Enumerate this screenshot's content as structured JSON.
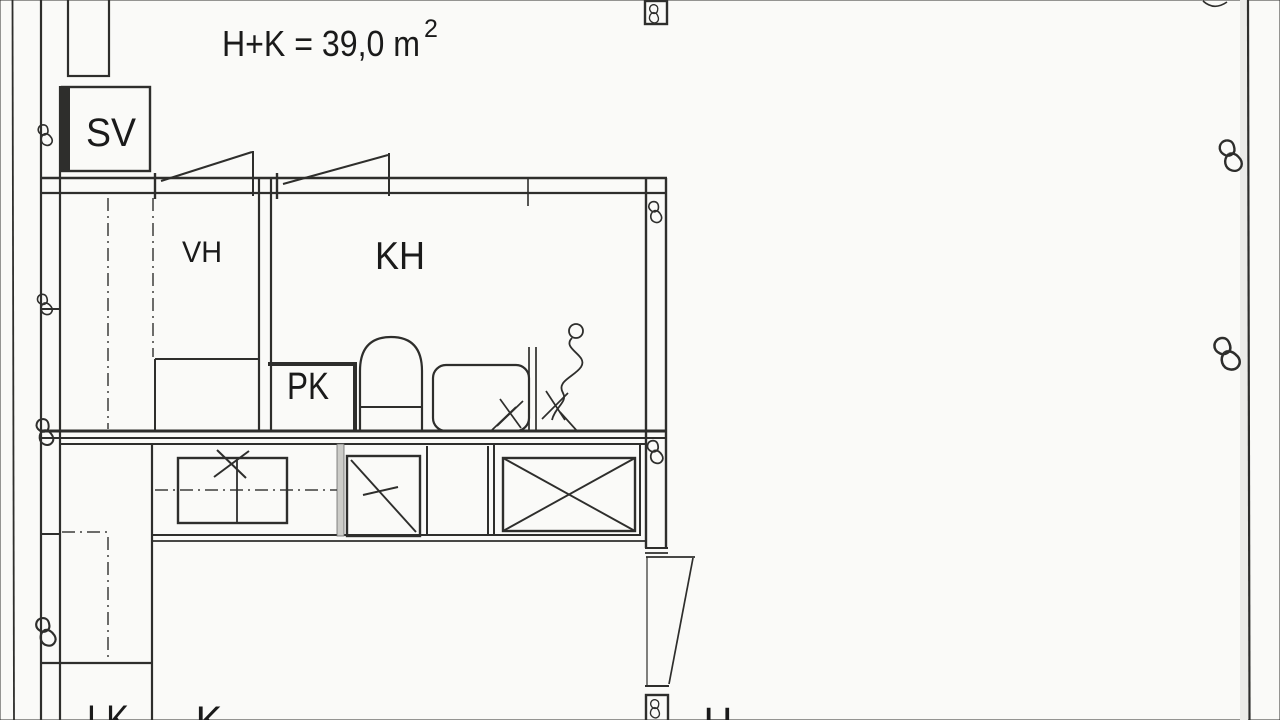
{
  "document": {
    "area_label": {
      "text": "H+K = 39,0 m",
      "superscript": "2"
    },
    "rooms": {
      "sv": "SV",
      "vh": "VH",
      "kh": "KH",
      "pk": "PK",
      "lk": "LK",
      "k": "K",
      "h": "H"
    },
    "colors": {
      "ink": "#2e2e2c",
      "text": "#1a1a1a",
      "paper": "#fafaf8",
      "shade": "#ebebe8"
    }
  }
}
